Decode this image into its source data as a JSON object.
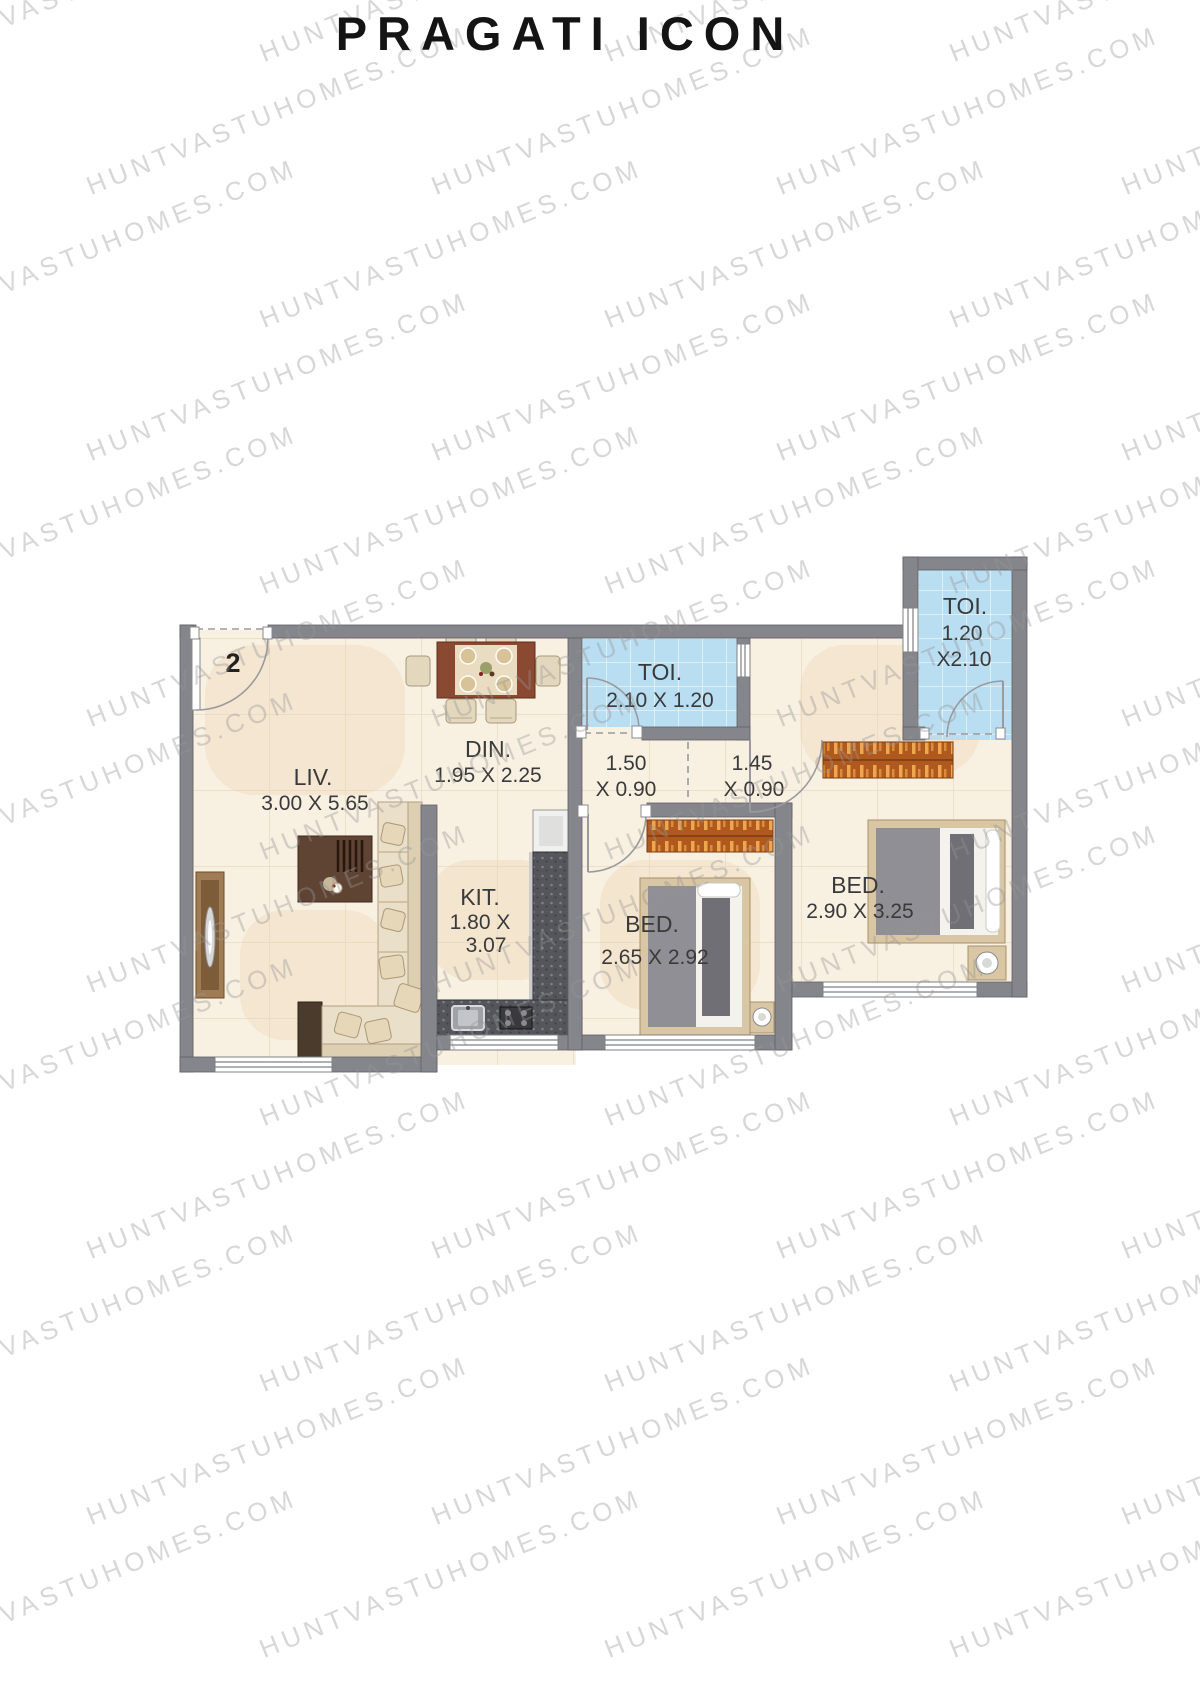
{
  "title": "PRAGATI ICON",
  "watermark": {
    "text": "HUNTVASTUHOMES.COM"
  },
  "unit_number": "2",
  "colors": {
    "wall": "#85868b",
    "floor": "#f8f0e1",
    "toilet_tile": "#b9ddf1",
    "wardrobe": "#b0591f",
    "counter": "#55565b",
    "text": "#3a3a3a"
  },
  "rooms": {
    "liv": {
      "name": "LIV.",
      "dims": "3.00 X 5.65"
    },
    "din": {
      "name": "DIN.",
      "dims": "1.95 X 2.25"
    },
    "kit": {
      "name": "KIT.",
      "dims_line1": "1.80 X",
      "dims_line2": "3.07"
    },
    "toi1": {
      "name": "TOI.",
      "dims": "2.10 X 1.20"
    },
    "toi2": {
      "name": "TOI.",
      "dims_line1": "1.20",
      "dims_line2": "X2.10"
    },
    "bed1": {
      "name": "BED.",
      "dims": "2.65 X 2.92"
    },
    "bed2": {
      "name": "BED.",
      "dims": "2.90 X 3.25"
    },
    "passage1": {
      "dims_line1": "1.50",
      "dims_line2": "X 0.90"
    },
    "passage2": {
      "dims_line1": "1.45",
      "dims_line2": "X 0.90"
    }
  }
}
